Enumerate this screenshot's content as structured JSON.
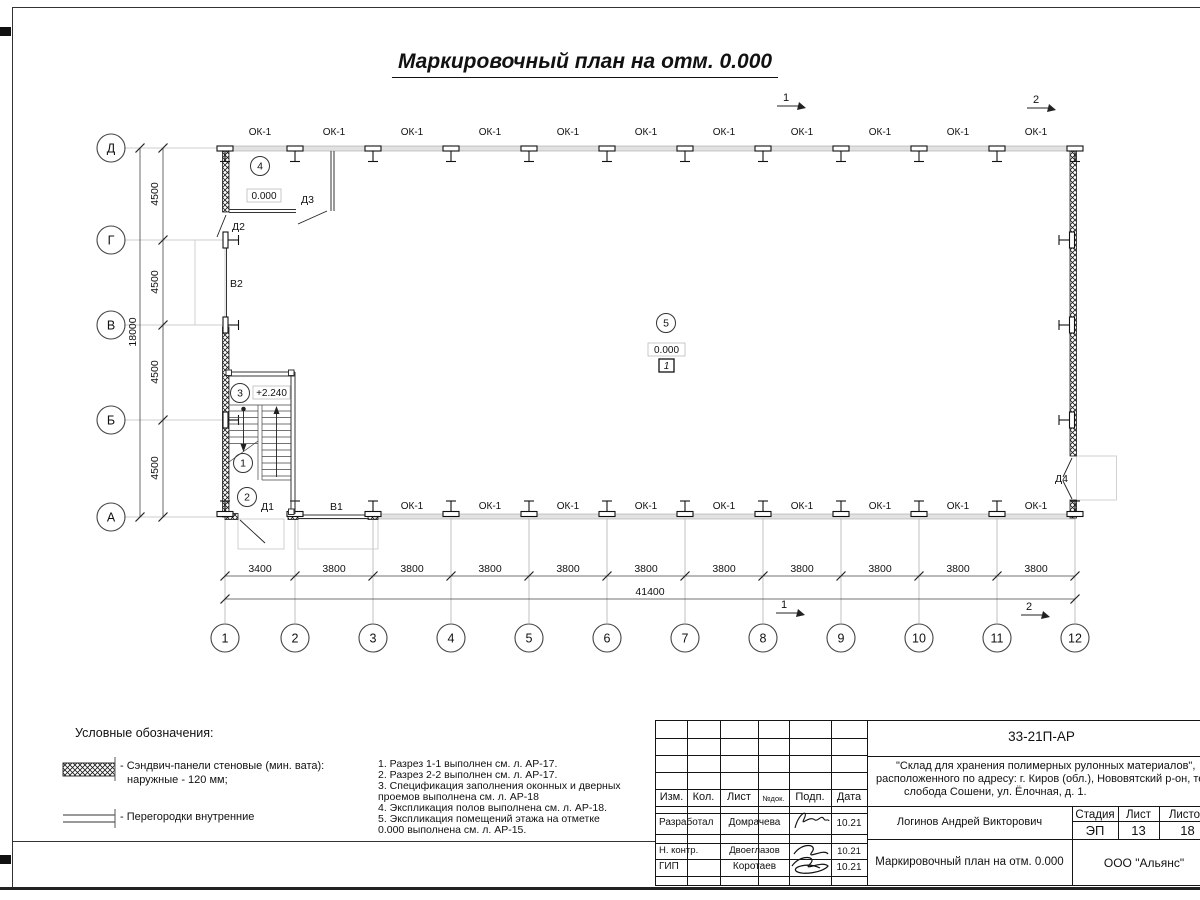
{
  "sheet": {
    "title": "Маркировочный план на отм. 0.000"
  },
  "plan": {
    "window_label": "ОК-1",
    "elevation_zero": "0.000",
    "elevation_stair": "+2.240",
    "floor_tag": "1",
    "rooms": [
      "1",
      "2",
      "3",
      "4",
      "5"
    ],
    "doors": [
      "Д1",
      "Д2",
      "Д3",
      "Д4"
    ],
    "gates": [
      "В1",
      "В2"
    ],
    "sections": [
      "1",
      "2"
    ]
  },
  "axes": {
    "letters": [
      "Д",
      "Г",
      "В",
      "Б",
      "А"
    ],
    "numbers": [
      "1",
      "2",
      "3",
      "4",
      "5",
      "6",
      "7",
      "8",
      "9",
      "10",
      "11",
      "12"
    ],
    "dims_left": [
      "4500",
      "4500",
      "4500",
      "4500"
    ],
    "total_left": "18000",
    "dims_bottom": [
      "3400",
      "3800",
      "3800",
      "3800",
      "3800",
      "3800",
      "3800",
      "3800",
      "3800",
      "3800",
      "3800"
    ],
    "total_bottom": "41400"
  },
  "legend": {
    "title": "Условные обозначения:",
    "item1_line1": "- Сэндвич-панели стеновые (мин. вата):",
    "item1_line2": "наружные - 120 мм;",
    "item2": "- Перегородки внутренние"
  },
  "notes": {
    "line1": "1. Разрез 1-1 выполнен см. л. АР-17.",
    "line2": "2. Разрез 2-2 выполнен см. л. АР-17.",
    "line3": "3. Спецификация заполнения оконных и дверных",
    "line4": "проемов выполнена см. л. АР-18",
    "line5": "4. Экспликация полов выполнена см. л. АР-18.",
    "line6": "5. Экспликация помещений этажа на отметке",
    "line7": "0.000 выполнена см. л. АР-15.",
    "line8": ""
  },
  "titleblock": {
    "code": "33-21П-АР",
    "project_line1": "\"Склад для хранения полимерных рулонных материалов\",",
    "project_line2": "расположенного по адресу: г. Киров (обл.), Нововятский р-он, те",
    "project_line3": "слобода Сошени, ул. Ёлочная, д. 1.",
    "col_izm": "Изм.",
    "col_kol": "Кол.",
    "col_list": "Лист",
    "col_ndok": "№док.",
    "col_podp": "Подп.",
    "col_data": "Дата",
    "row1_role": "Разработал",
    "row1_name": "Домрачева",
    "row1_date": "10.21",
    "row2_role": "Н. контр.",
    "row2_name": "Двоеглазов",
    "row2_date": "10.21",
    "row3_role": "ГИП",
    "row3_name": "Коротаев",
    "row3_date": "10.21",
    "chief": "Логинов Андрей Викторович",
    "stage_label": "Стадия",
    "sheet_label": "Лист",
    "sheets_label": "Листов",
    "stage": "ЭП",
    "sheet_num": "13",
    "sheets_total": "18",
    "drawing_title": "Маркировочный план на отм. 0.000",
    "company": "ООО \"Альянс\""
  }
}
